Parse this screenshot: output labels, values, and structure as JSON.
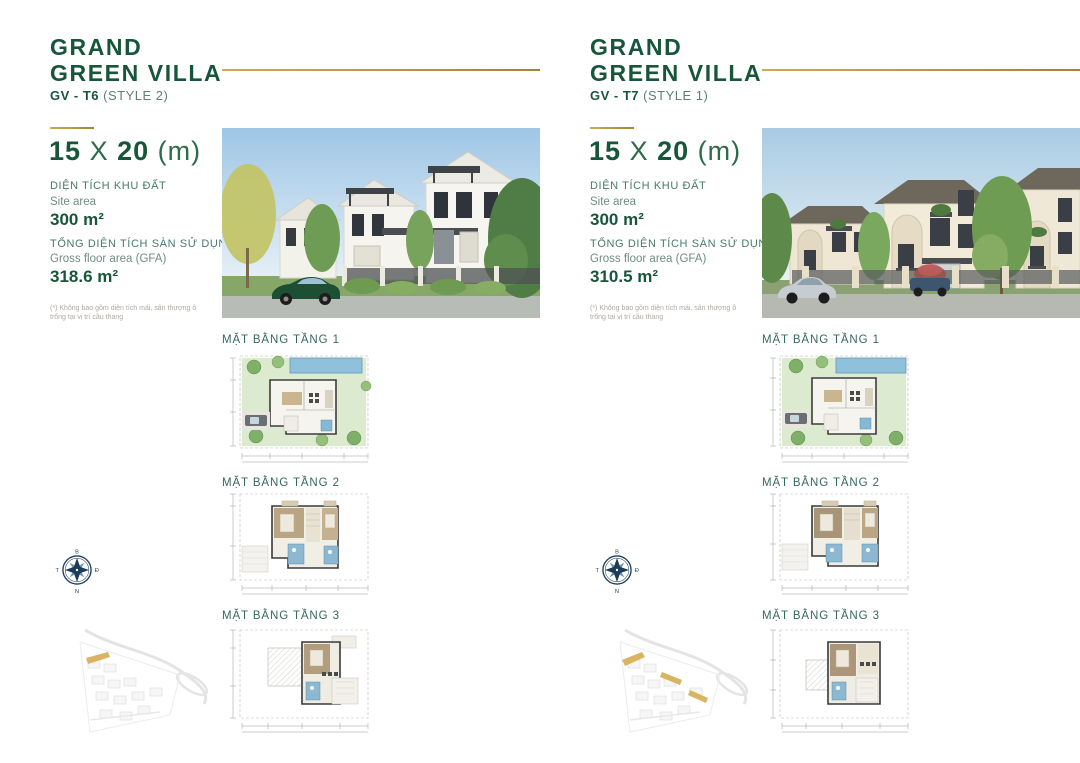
{
  "panels": [
    {
      "title_line1": "GRAND",
      "title_line2": "GREEN VILLA",
      "model_code": "GV - T6",
      "style_label": "(STYLE 2)",
      "dim_width": "15",
      "dim_sep": "X",
      "dim_depth": "20",
      "dim_unit": "(m)",
      "site_area_label_vi": "DIỆN TÍCH KHU ĐẤT",
      "site_area_label_en": "Site area",
      "site_area_value": "300 m²",
      "gfa_label_vi": "TỔNG DIỆN TÍCH SÀN SỬ DỤNG",
      "gfa_label_en": "Gross floor area (GFA)",
      "gfa_value": "318.6 m²",
      "footnote": "(*) Không bao gồm diện tích mái, sân thượng ô trống tại vị trí cầu thang",
      "floorplan_labels": [
        "MẶT BẰNG TẦNG 1",
        "MẶT BẰNG TẦNG 2",
        "MẶT BẰNG TẦNG 3"
      ]
    },
    {
      "title_line1": "GRAND",
      "title_line2": "GREEN VILLA",
      "model_code": "GV - T7",
      "style_label": "(STYLE 1)",
      "dim_width": "15",
      "dim_sep": "X",
      "dim_depth": "20",
      "dim_unit": "(m)",
      "site_area_label_vi": "DIỆN TÍCH KHU ĐẤT",
      "site_area_label_en": "Site area",
      "site_area_value": "300 m²",
      "gfa_label_vi": "TỔNG DIỆN TÍCH SÀN SỬ DỤNG",
      "gfa_label_en": "Gross floor area (GFA)",
      "gfa_value": "310.5 m²",
      "footnote": "(*) Không bao gồm diện tích mái, sân thượng ô trống tại vị trí cầu thang",
      "floorplan_labels": [
        "MẶT BẰNG TẦNG 1",
        "MẶT BẰNG TẦNG 2",
        "MẶT BẰNG TẦNG 3"
      ]
    }
  ],
  "compass": {
    "north": "B",
    "east": "Đ",
    "south": "N",
    "west": "T"
  },
  "colors": {
    "brand_green": "#17563A",
    "accent_gold": "#C0A04C",
    "label_teal": "#477A6B",
    "plan_label_teal": "#35685C",
    "compass_navy": "#1C3D5A"
  }
}
